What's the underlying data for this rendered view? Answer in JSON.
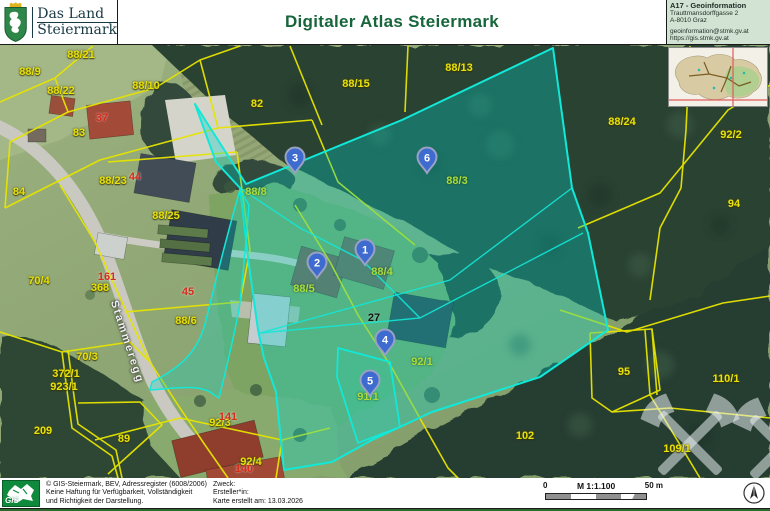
{
  "header": {
    "logo": {
      "line1": "Das Land",
      "line2": "Steiermark"
    },
    "title": "Digitaler Atlas Steiermark",
    "contact": {
      "dept": "A17 - Geoinformation",
      "address1": "Trauttmansdorffgasse 2",
      "address2": "A-8010 Graz",
      "email": "geoinformation@stmk.gv.at",
      "url": "https://gis.stmk.gv.at"
    }
  },
  "map": {
    "street_label": "Stammeregg",
    "labels": [
      {
        "t": "88/9",
        "x": 30,
        "y": 72,
        "c": "yellow"
      },
      {
        "t": "88/21",
        "x": 81,
        "y": 55,
        "c": "yellow"
      },
      {
        "t": "88/22",
        "x": 61,
        "y": 91,
        "c": "yellow"
      },
      {
        "t": "88/10",
        "x": 146,
        "y": 86,
        "c": "yellow"
      },
      {
        "t": "83",
        "x": 79,
        "y": 133,
        "c": "yellow"
      },
      {
        "t": "37",
        "x": 102,
        "y": 118,
        "c": "red"
      },
      {
        "t": "88/23",
        "x": 113,
        "y": 181,
        "c": "yellow"
      },
      {
        "t": "44",
        "x": 135,
        "y": 177,
        "c": "red"
      },
      {
        "t": "84",
        "x": 19,
        "y": 192,
        "c": "yellow"
      },
      {
        "t": "88/25",
        "x": 166,
        "y": 216,
        "c": "yellow"
      },
      {
        "t": "82",
        "x": 257,
        "y": 104,
        "c": "yellow"
      },
      {
        "t": "88/15",
        "x": 356,
        "y": 84,
        "c": "yellow"
      },
      {
        "t": "88/13",
        "x": 459,
        "y": 68,
        "c": "yellow"
      },
      {
        "t": "88/24",
        "x": 622,
        "y": 122,
        "c": "yellow"
      },
      {
        "t": "92/2",
        "x": 731,
        "y": 135,
        "c": "yellow"
      },
      {
        "t": "94",
        "x": 734,
        "y": 204,
        "c": "yellow"
      },
      {
        "t": "161",
        "x": 107,
        "y": 277,
        "c": "red"
      },
      {
        "t": "368",
        "x": 100,
        "y": 288,
        "c": "yellow"
      },
      {
        "t": "70/4",
        "x": 39,
        "y": 281,
        "c": "yellow"
      },
      {
        "t": "45",
        "x": 188,
        "y": 292,
        "c": "red"
      },
      {
        "t": "88/6",
        "x": 186,
        "y": 321,
        "c": "yellow"
      },
      {
        "t": "70/3",
        "x": 87,
        "y": 357,
        "c": "yellow"
      },
      {
        "t": "372/1",
        "x": 66,
        "y": 374,
        "c": "yellow"
      },
      {
        "t": "923/1",
        "x": 64,
        "y": 387,
        "c": "yellow"
      },
      {
        "t": "209",
        "x": 43,
        "y": 431,
        "c": "yellow"
      },
      {
        "t": "89",
        "x": 124,
        "y": 439,
        "c": "yellow"
      },
      {
        "t": "92/3",
        "x": 220,
        "y": 423,
        "c": "yellow"
      },
      {
        "t": "141",
        "x": 228,
        "y": 417,
        "c": "red"
      },
      {
        "t": "92/4",
        "x": 251,
        "y": 462,
        "c": "yellow"
      },
      {
        "t": "140",
        "x": 244,
        "y": 469,
        "c": "red"
      },
      {
        "t": "102",
        "x": 525,
        "y": 436,
        "c": "yellow"
      },
      {
        "t": "95",
        "x": 624,
        "y": 372,
        "c": "yellow"
      },
      {
        "t": "110/1",
        "x": 726,
        "y": 379,
        "c": "yellow"
      },
      {
        "t": "109/1",
        "x": 677,
        "y": 449,
        "c": "yellow"
      },
      {
        "t": "88/8",
        "x": 256,
        "y": 192,
        "c": "lime"
      },
      {
        "t": "88/3",
        "x": 457,
        "y": 181,
        "c": "lime"
      },
      {
        "t": "88/4",
        "x": 382,
        "y": 272,
        "c": "lime"
      },
      {
        "t": "88/5",
        "x": 304,
        "y": 289,
        "c": "lime"
      },
      {
        "t": "92/1",
        "x": 422,
        "y": 362,
        "c": "lime"
      },
      {
        "t": "91/1",
        "x": 368,
        "y": 397,
        "c": "lime"
      },
      {
        "t": "27",
        "x": 374,
        "y": 318,
        "c": "black"
      }
    ],
    "markers": [
      {
        "n": "1",
        "x": 365,
        "y": 250
      },
      {
        "n": "2",
        "x": 317,
        "y": 263
      },
      {
        "n": "3",
        "x": 295,
        "y": 158
      },
      {
        "n": "4",
        "x": 385,
        "y": 340
      },
      {
        "n": "5",
        "x": 370,
        "y": 381
      },
      {
        "n": "6",
        "x": 427,
        "y": 158
      }
    ]
  },
  "footer": {
    "copyright": [
      "© GIS-Steiermark, BEV, Adressregister (6008/2006)",
      "Keine Haftung für Verfügbarkeit, Vollständigkeit",
      "und Richtigkeit der Darstellung."
    ],
    "purpose_label": "Zweck:",
    "creator_label": "Ersteller*in:",
    "date_label": "Karte erstellt am: 13.03.2026",
    "scale": {
      "zero": "0",
      "ratio": "M 1:1.100",
      "distance": "50 m"
    },
    "gis_logo_text": "GIS"
  },
  "colors": {
    "title_green": "#17663b",
    "selection_cyan": "#12e8d8",
    "parcel_yellow": "#e8e10a",
    "house_red": "#d62b1a",
    "selected_parcel_lime": "#abdc3e",
    "marker_blue": "#3e6bcf"
  }
}
